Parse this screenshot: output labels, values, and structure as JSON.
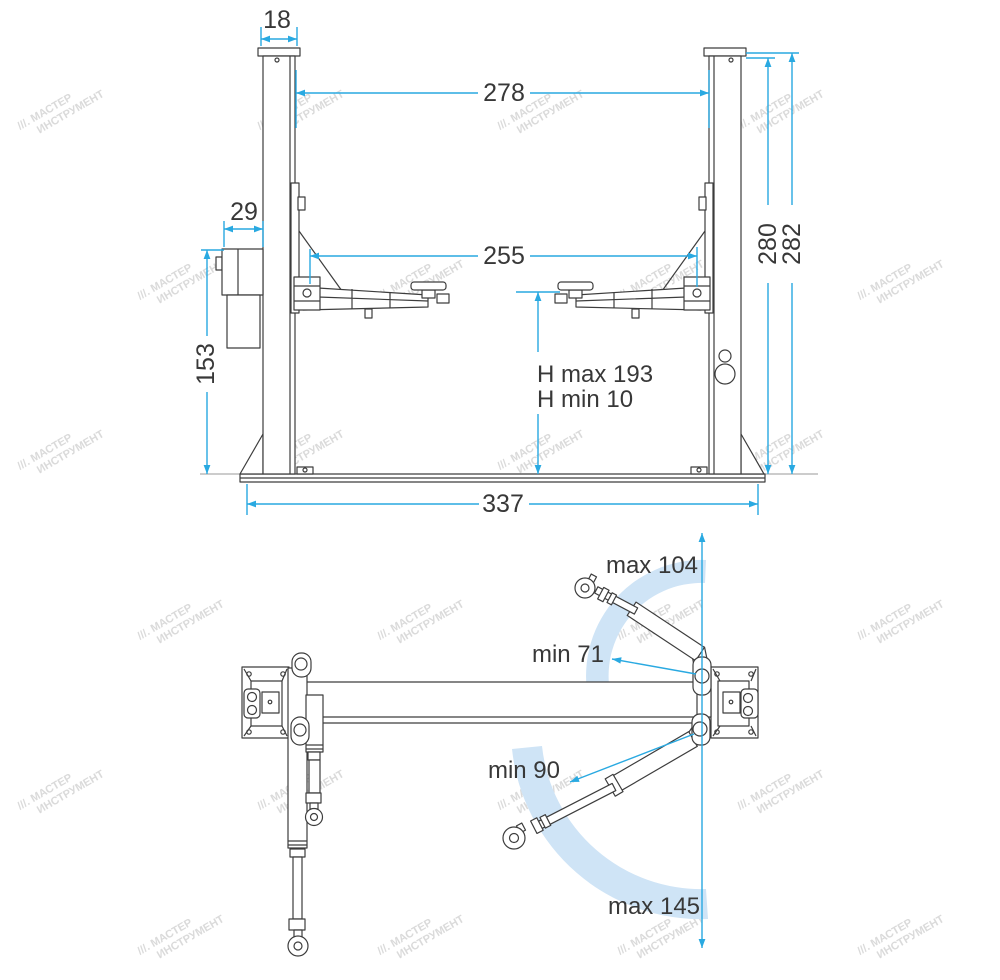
{
  "watermark": {
    "line1": "///. МАСТЕР",
    "line2": "ИНСТРУМЕНТ"
  },
  "colors": {
    "dimension_blue": "#29a9e1",
    "arc_band_blue": "#cfe4f6",
    "line_art": "#3d3d3d",
    "watermark_gray": "#dadada",
    "background": "#ffffff"
  },
  "front_view": {
    "dims": {
      "post_width": "18",
      "inner_span": "278",
      "motor_width": "29",
      "arm_span": "255",
      "motor_height": "153",
      "column_height": "280",
      "total_height": "282",
      "base_width": "337"
    },
    "labels": {
      "h_max": "H max 193",
      "h_min": "H min 10"
    }
  },
  "top_view": {
    "labels": {
      "arm_front_max": "max 104",
      "arm_front_min": "min 71",
      "arm_rear_min": "min 90",
      "arm_rear_max": "max 145"
    }
  }
}
